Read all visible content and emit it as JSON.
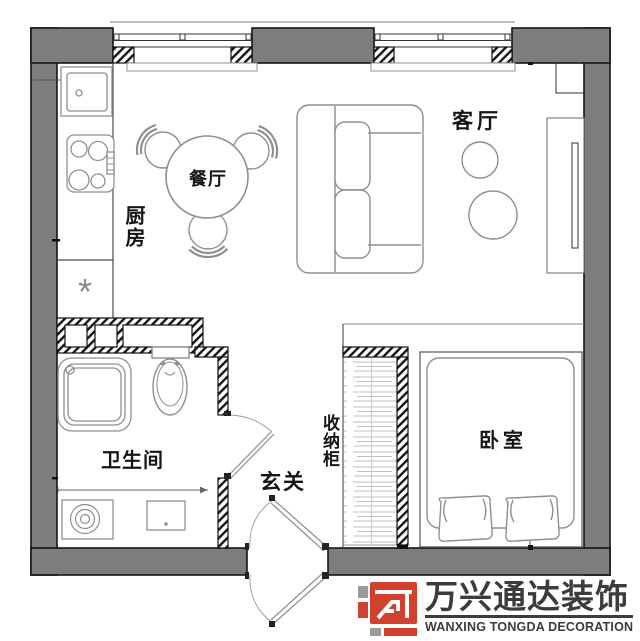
{
  "rooms": {
    "kitchen": {
      "label": "厨房"
    },
    "dining": {
      "label": "餐厅"
    },
    "living": {
      "label": "客厅"
    },
    "bathroom": {
      "label": "卫生间"
    },
    "entry": {
      "label": "玄关"
    },
    "storage": {
      "label": "收纳柜"
    },
    "bedroom": {
      "label": "卧室"
    }
  },
  "symbols": {
    "kitchen_asterisk": "*"
  },
  "watermark": {
    "brand_cn": "万兴通达装饰",
    "brand_en": "WANXING TONGDA DECORATION"
  },
  "colors": {
    "wall_gray": "#7d7d7d",
    "line_dark": "#151515",
    "furniture_gray": "#8f8f8f",
    "logo_red": "#d2402e",
    "logo_dark": "#3c3c3c",
    "logo_gray": "#9a9a9a"
  }
}
